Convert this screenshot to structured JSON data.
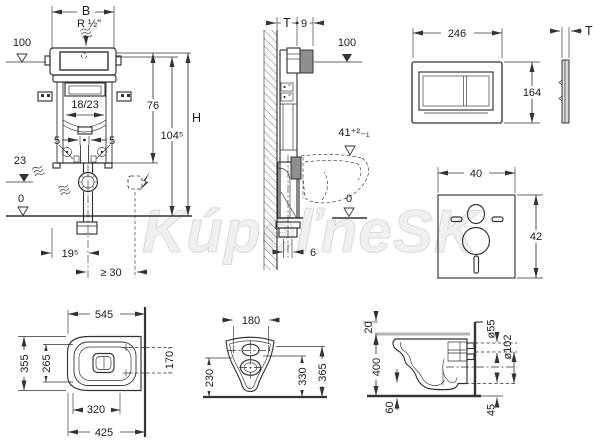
{
  "colors": {
    "line": "#333333",
    "dark_gray": "#8f8f8f",
    "light_gray": "#d9d9d9",
    "seat_gray": "#b3b3b3",
    "watermark": "#f0f0f0"
  },
  "watermark": {
    "text": "KúpeľneSK"
  },
  "views": {
    "frame_front": {
      "width": "B",
      "water_connection": "R ½\"",
      "top_level": "100",
      "tank_depth": "18/23",
      "height_76": "76",
      "height_total": "H",
      "height_104_5": "104⁵",
      "offset_left": "5",
      "offset_right": "5",
      "waste_level": "23",
      "floor_level": "0",
      "drain_offset": "19⁵",
      "min_clearance": "≥ 30"
    },
    "frame_side": {
      "wall_thickness": "T",
      "box_depth": "9",
      "top_level": "100",
      "outlet_height": "41⁺²₋₁",
      "floor_level": "0",
      "outlet_offset": "6"
    },
    "flush_plate": {
      "width": "246",
      "height": "164",
      "thickness": "T"
    },
    "sound_pad": {
      "width": "40",
      "height": "42"
    },
    "wc_plan": {
      "depth": "545",
      "width": "355",
      "inner_width": "265",
      "fixing_distance": "170",
      "dim_320": "320",
      "dim_425": "425"
    },
    "wc_rear": {
      "fixing_width": "180",
      "height_230": "230",
      "height_330": "330",
      "height_365": "365"
    },
    "wc_side": {
      "seat_thickness": "20",
      "seat_height": "400",
      "front_clearance": "60",
      "rear_clearance": "45",
      "inlet_diameter": "ø55",
      "outlet_diameter": "ø102"
    }
  }
}
